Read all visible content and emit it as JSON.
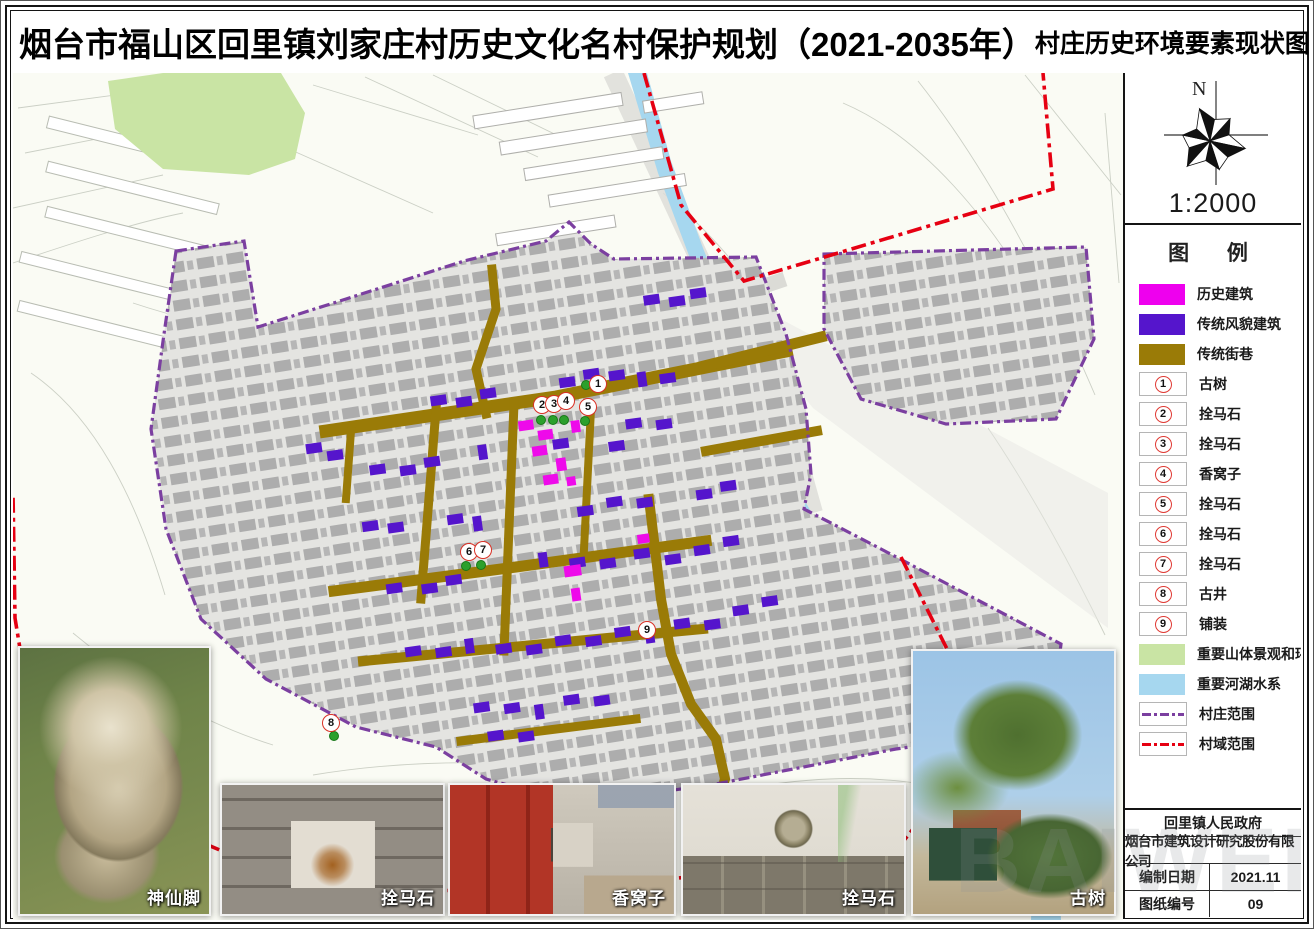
{
  "header": {
    "title": "烟台市福山区回里镇刘家庄村历史文化名村保护规划（2021-2035年）",
    "subtitle": "村庄历史环境要素现状图"
  },
  "compass": {
    "north_label": "N",
    "scale": "1:2000"
  },
  "legend": {
    "title": "图  例",
    "swatches": [
      {
        "label": "历史建筑",
        "color": "#EE00EE"
      },
      {
        "label": "传统风貌建筑",
        "color": "#5515CC"
      },
      {
        "label": "传统街巷",
        "color": "#9A7B07"
      }
    ],
    "numbered": [
      {
        "num": "1",
        "label": "古树"
      },
      {
        "num": "2",
        "label": "拴马石"
      },
      {
        "num": "3",
        "label": "拴马石"
      },
      {
        "num": "4",
        "label": "香窝子"
      },
      {
        "num": "5",
        "label": "拴马石"
      },
      {
        "num": "6",
        "label": "拴马石"
      },
      {
        "num": "7",
        "label": "拴马石"
      },
      {
        "num": "8",
        "label": "古井"
      },
      {
        "num": "9",
        "label": "铺装"
      }
    ],
    "areas": [
      {
        "label": "重要山体景观和环境",
        "color": "#C9E4A4"
      },
      {
        "label": "重要河湖水系",
        "color": "#A6D7EF"
      }
    ],
    "lines": [
      {
        "label": "村庄范围",
        "color": "#7B3FA0"
      },
      {
        "label": "村域范围",
        "color": "#E60012"
      }
    ]
  },
  "map": {
    "markers": [
      {
        "num": "1",
        "x": 585,
        "y": 311
      },
      {
        "num": "2",
        "x": 529,
        "y": 332
      },
      {
        "num": "3",
        "x": 541,
        "y": 331
      },
      {
        "num": "4",
        "x": 553,
        "y": 328
      },
      {
        "num": "5",
        "x": 575,
        "y": 334
      },
      {
        "num": "6",
        "x": 456,
        "y": 479
      },
      {
        "num": "7",
        "x": 470,
        "y": 477
      },
      {
        "num": "8",
        "x": 318,
        "y": 650
      },
      {
        "num": "9",
        "x": 634,
        "y": 557
      }
    ],
    "green_dots": [
      {
        "x": 573,
        "y": 312
      },
      {
        "x": 528,
        "y": 347
      },
      {
        "x": 540,
        "y": 347
      },
      {
        "x": 551,
        "y": 347
      },
      {
        "x": 572,
        "y": 348
      },
      {
        "x": 453,
        "y": 493
      },
      {
        "x": 468,
        "y": 492
      },
      {
        "x": 321,
        "y": 663
      }
    ]
  },
  "photos": [
    {
      "caption": "神仙脚"
    },
    {
      "caption": "拴马石"
    },
    {
      "caption": "香窝子"
    },
    {
      "caption": "拴马石"
    },
    {
      "caption": "古树"
    }
  ],
  "infobox": {
    "government": "回里镇人民政府",
    "company": "烟台市建筑设计研究股份有限公司",
    "date_label": "编制日期",
    "date_value": "2021.11",
    "number_label": "图纸编号",
    "number_value": "09"
  },
  "watermark": "BAIWEI"
}
